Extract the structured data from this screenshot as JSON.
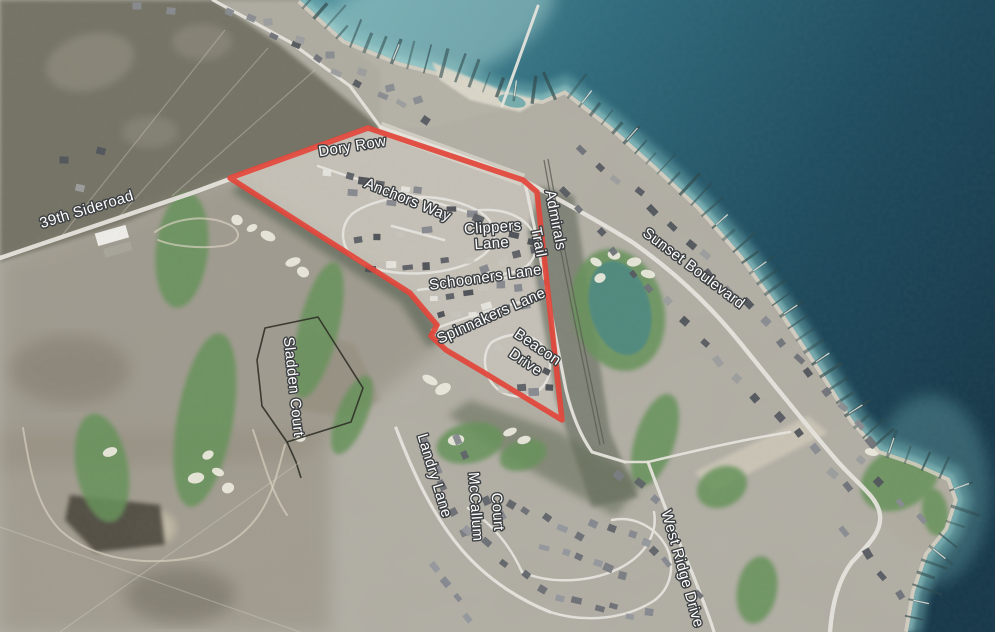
{
  "map": {
    "type": "aerial-satellite-view",
    "highlighted_parcel_color": "#e2463a",
    "colors": {
      "water_deep": "#16384a",
      "water_mid": "#2e6a7c",
      "water_shore": "#8fc4c4",
      "land": "#b3b0a7",
      "golf_green": "#66935a",
      "woodland": "#6f6e61",
      "road": "#e7e5de",
      "label_fill": "#ffffff",
      "label_halo": "#3d4043"
    },
    "labels": [
      {
        "id": "39th-sideroad",
        "text": "39th Sideroad",
        "transform": "translate(88,214) rotate(-17)"
      },
      {
        "id": "dory-row",
        "text": "Dory Row",
        "transform": "translate(353,151) rotate(-9)"
      },
      {
        "id": "anchors-way",
        "text": "Anchors Way",
        "transform": "translate(406,204) rotate(22)"
      },
      {
        "id": "clippers-1",
        "text": "Clippers",
        "transform": "translate(493,232) rotate(-4)"
      },
      {
        "id": "clippers-2",
        "text": "Lane",
        "transform": "translate(492,248) rotate(-4)"
      },
      {
        "id": "admirals",
        "text": "Admirals",
        "transform": "translate(551,221) rotate(79)"
      },
      {
        "id": "admirals-trail",
        "text": "Trail",
        "transform": "translate(534,243) rotate(79)"
      },
      {
        "id": "sunset-blvd",
        "text": "Sunset Boulevard",
        "transform": "translate(691,272) rotate(37)"
      },
      {
        "id": "schooners-lane",
        "text": "Schooners Lane",
        "transform": "translate(486,282) rotate(-8)"
      },
      {
        "id": "spinnakers-lane",
        "text": "Spinnakers Lane",
        "transform": "translate(493,320) rotate(-24)"
      },
      {
        "id": "beacon-1",
        "text": "Beacon",
        "transform": "translate(535,351) rotate(34)"
      },
      {
        "id": "beacon-2",
        "text": "Drive",
        "transform": "translate(523,366) rotate(34)"
      },
      {
        "id": "sladden-court",
        "text": "Sladden Court",
        "transform": "translate(289,387) rotate(84)"
      },
      {
        "id": "landry-lane",
        "text": "Landry Lane",
        "transform": "translate(430,477) rotate(73)"
      },
      {
        "id": "mccallum-1",
        "text": "McCallum",
        "transform": "translate(471,507) rotate(86)"
      },
      {
        "id": "mccallum-2",
        "text": "Court",
        "transform": "translate(493,512) rotate(86)"
      },
      {
        "id": "west-ridge-dr",
        "text": "West Ridge Drive",
        "transform": "translate(678,570) rotate(74)"
      }
    ],
    "highlight_polygon": {
      "points": "230,178 368,128 523,180 537,192 562,420 483,372 446,350 431,336 437,325 410,293"
    },
    "parcel_polygon": {
      "points": "265,328 318,317 363,388 351,422 287,442 262,406 257,360"
    }
  }
}
